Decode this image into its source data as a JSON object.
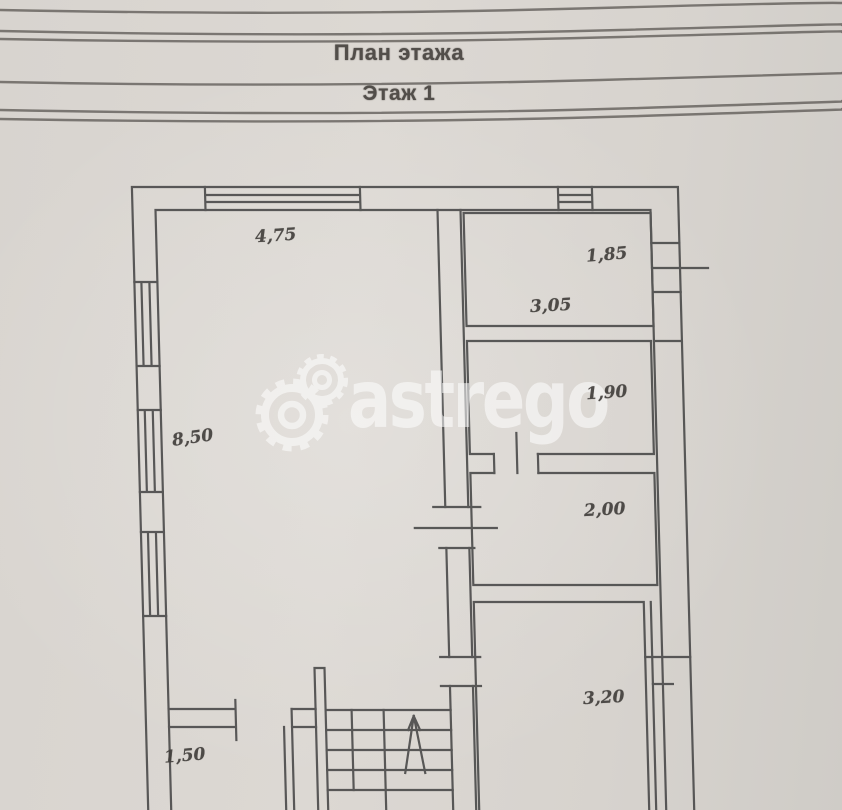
{
  "page": {
    "title": "План этажа",
    "subtitle": "Этаж 1"
  },
  "watermark": {
    "text": "astrego"
  },
  "plan": {
    "type": "floor-plan",
    "floor_label": "Этаж 1",
    "dimensions": {
      "main_room_width": "4,75",
      "main_room_depth": "8,50",
      "room_top_right_width": "3,05",
      "right_window_width": "1,85",
      "room_right_upper": "1,90",
      "room_right_middle": "2,00",
      "room_bottom_right": "3,20",
      "room_bottom_left": "1,50"
    },
    "colors": {
      "ink": "#464646",
      "paper": "#d8d4cf",
      "watermark": "#ffffff"
    }
  }
}
